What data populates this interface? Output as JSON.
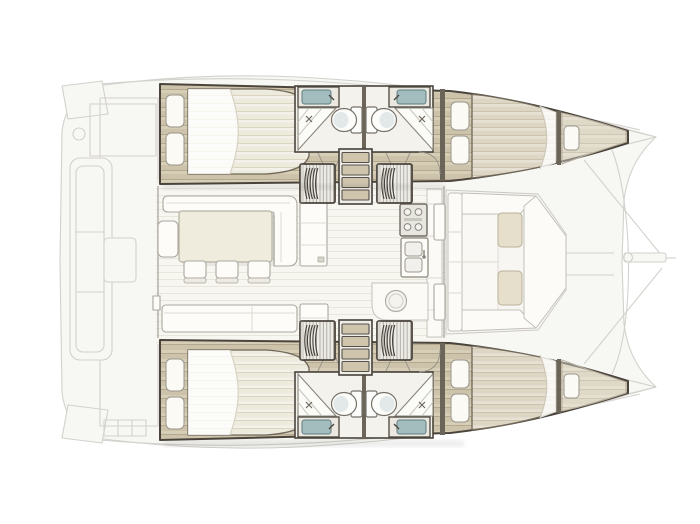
{
  "meta": {
    "view": "catamaran-interior-deck-plan",
    "bow_direction": "right",
    "stern_direction": "left"
  },
  "colors": {
    "background": "#ffffff",
    "ghost_line": "#d3d1cc",
    "ghost_fill": "#f7f7f4",
    "outline": "#4a443c",
    "wall": "#6a6459",
    "wood_base": "#cdc3aa",
    "wood_stripe": "#b4a98f",
    "wood_highlight": "#ddd5bf",
    "white_floor": "#f7f6f1",
    "floor_line": "#e9e6dd",
    "mattress": "#edeade",
    "mattress_stripe": "#dbd4c1",
    "fwd_mattress": "#ded6c5",
    "fwd_mattress_stripe": "#ccc3ac",
    "pillow": "#fbfaf5",
    "furniture": "#fdfcf9",
    "furniture_line": "#aaa79e",
    "table": "#efecdd",
    "sink_teal": "#a3bcbd",
    "toilet_bowl": "#e3e8e8",
    "cushion": "#e6dfcb",
    "tread": "#cfc5ad",
    "slat": "#a8a59d",
    "stair_dark": "#45403a"
  },
  "floorplan": {
    "hulls": [
      {
        "name": "upper-hull",
        "rooms": [
          {
            "name": "aft-cabin",
            "items": [
              "double-berth",
              "pillow",
              "pillow",
              "wood-floor"
            ]
          },
          {
            "name": "aft-head",
            "items": [
              "vanity-sink",
              "toilet",
              "corner-shower",
              "door-swing"
            ]
          },
          {
            "name": "forward-head",
            "items": [
              "vanity-sink",
              "toilet",
              "corner-shower",
              "door-swing"
            ]
          },
          {
            "name": "forward-cabin",
            "items": [
              "double-berth",
              "pillow",
              "pillow"
            ]
          },
          {
            "name": "forepeak-berth",
            "items": [
              "single-cushion"
            ]
          }
        ],
        "stairs": [
          "aft-companionway-stairs",
          "forward-companionway-stairs",
          "center-steps"
        ]
      },
      {
        "name": "lower-hull",
        "mirror_of": "upper-hull"
      }
    ],
    "saloon": {
      "furniture": [
        "l-shaped-sofa",
        "stool",
        "dining-table",
        "dining-chair",
        "dining-chair",
        "dining-chair",
        "sideboard",
        "aft-bench",
        "aft-sideboard"
      ],
      "galley": [
        "stove-4-burners",
        "double-sink",
        "counter-strip",
        "round-basin",
        "peninsula-counter"
      ]
    },
    "forward_cockpit": {
      "furniture": [
        "left-bench",
        "top-bench",
        "bottom-bench",
        "right-bench",
        "seat-cushion",
        "seat-cushion"
      ],
      "access": "door-in-forward-bulkhead"
    },
    "exterior": {
      "ghosted_elements": [
        "hull-silhouette",
        "transom-steps",
        "aft-cockpit-floor",
        "aft-cockpit-bench",
        "aft-table",
        "aft-steps",
        "side-deck-edges",
        "foredeck-seams",
        "forward-crossbeam",
        "bow-bridle-lines",
        "bowsprit"
      ]
    }
  }
}
